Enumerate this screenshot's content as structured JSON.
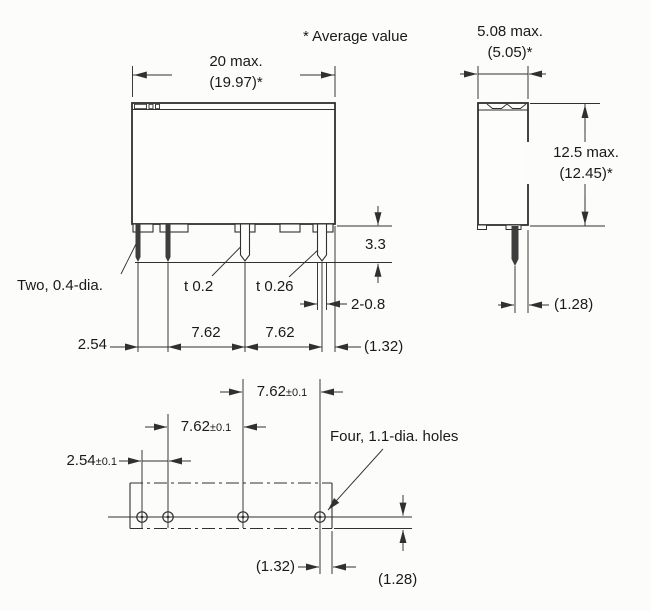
{
  "notes": {
    "average_value": "* Average value"
  },
  "front_view": {
    "width_max": "20 max.",
    "width_avg": "(19.97)*",
    "terminal_label": "Two, 0.4-dia.",
    "thickness_mid": "t 0.2",
    "thickness_right": "t 0.26",
    "terminal_length": "3.3",
    "terminal_width": "2-0.8",
    "pitch_small": "2.54",
    "pitch_mid": "7.62",
    "pitch_right": "7.62",
    "edge_gap": "(1.32)"
  },
  "side_view": {
    "depth_max": "5.08 max.",
    "depth_avg": "(5.05)*",
    "height_max": "12.5 max.",
    "height_avg": "(12.45)*",
    "terminal_gap": "(1.28)"
  },
  "bottom_view": {
    "holes_label": "Four, 1.1-dia. holes",
    "pitch_top_value": "7.62",
    "pitch_top_tol": "±0.1",
    "pitch_mid_value": "7.62",
    "pitch_mid_tol": "±0.1",
    "pitch_small_value": "2.54",
    "pitch_small_tol": "±0.1",
    "edge_gap_x": "(1.32)",
    "edge_gap_y": "(1.28)"
  },
  "colors": {
    "line": "#303030",
    "text": "#1a1a1a",
    "background": "#fcfcfb"
  }
}
